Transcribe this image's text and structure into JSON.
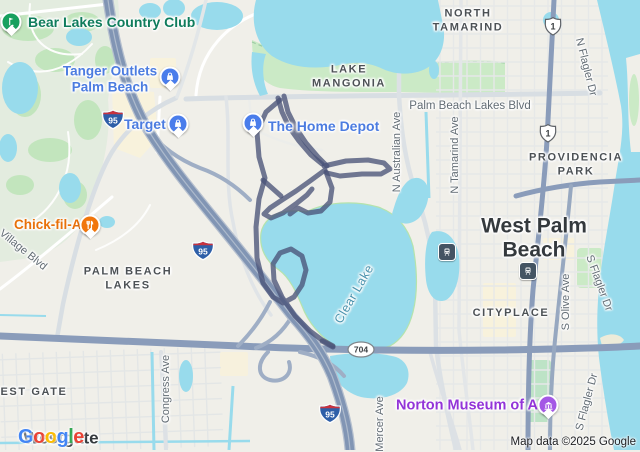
{
  "map": {
    "attribution": "Map data ©2025 Google",
    "google_logo": {
      "letters": [
        {
          "ch": "G",
          "color": "#4285F4"
        },
        {
          "ch": "o",
          "color": "#EA4335"
        },
        {
          "ch": "o",
          "color": "#FBBC05"
        },
        {
          "ch": "g",
          "color": "#4285F4"
        },
        {
          "ch": "l",
          "color": "#34A853"
        },
        {
          "ch": "e",
          "color": "#EA4335"
        }
      ]
    },
    "colors": {
      "land": "#F0EFE9",
      "water": "#98DBEC",
      "route": "#4A5378",
      "freeway": "#8195B4",
      "major_road": "#8A9CBA",
      "shopping_poi": "#4C7CE0",
      "restaurant_poi": "#E8710A",
      "attraction_poi": "#9334D8",
      "park_poi": "#0F7C5C"
    },
    "pois": [
      {
        "id": "bear-lakes-country-club",
        "lines": [
          "Bear Lakes Country Club"
        ],
        "color": "#0F7C5C",
        "size": 14,
        "icon": "golf-icon",
        "pin": {
          "x": 11,
          "y": 22,
          "bg": "#17A05E"
        },
        "text": {
          "x": 28,
          "y": 22,
          "align": "left"
        }
      },
      {
        "id": "tanger-outlets-palm-beach",
        "lines": [
          "Tanger Outlets",
          "Palm Beach"
        ],
        "color": "#4C7CE0",
        "size": 13.5,
        "icon": "shopping-bag-icon",
        "pin": {
          "x": 170,
          "y": 77,
          "bg": "#4A7DEB"
        },
        "text": {
          "x": 110,
          "y": 79,
          "align": "center"
        }
      },
      {
        "id": "target",
        "lines": [
          "Target"
        ],
        "color": "#4C7CE0",
        "size": 14,
        "icon": "shopping-bag-icon",
        "pin": {
          "x": 178,
          "y": 124,
          "bg": "#4A7DEB"
        },
        "text": {
          "x": 124,
          "y": 124,
          "align": "left"
        }
      },
      {
        "id": "the-home-depot",
        "lines": [
          "The Home Depot"
        ],
        "color": "#4C7CE0",
        "size": 14,
        "icon": "shopping-bag-icon",
        "pin": {
          "x": 253,
          "y": 123,
          "bg": "#4A7DEB"
        },
        "text": {
          "x": 268,
          "y": 126,
          "align": "left"
        }
      },
      {
        "id": "chick-fil-a",
        "lines": [
          "Chick-fil-A"
        ],
        "color": "#E8710A",
        "size": 13.5,
        "icon": "restaurant-icon",
        "pin": {
          "x": 90,
          "y": 225,
          "bg": "#F1760C"
        },
        "text": {
          "x": 14,
          "y": 225,
          "align": "left"
        }
      },
      {
        "id": "norton-museum-of-art",
        "lines": [
          "Norton Museum of Art"
        ],
        "color": "#9334D8",
        "size": 14.5,
        "icon": "museum-icon",
        "pin": {
          "x": 548,
          "y": 405,
          "bg": "#A458E5"
        },
        "text": {
          "x": 396,
          "y": 406,
          "align": "left"
        }
      }
    ],
    "area_labels": [
      {
        "id": "lake-mangonia",
        "lines": [
          "LAKE",
          "MANGONIA"
        ],
        "x": 349,
        "y": 77
      },
      {
        "id": "north-tamarind",
        "lines": [
          "NORTH",
          "TAMARIND"
        ],
        "x": 468,
        "y": 21
      },
      {
        "id": "providencia-park",
        "lines": [
          "PROVIDENCIA",
          "PARK"
        ],
        "x": 576,
        "y": 165
      },
      {
        "id": "palm-beach-lakes",
        "lines": [
          "PALM BEACH",
          "LAKES"
        ],
        "x": 128,
        "y": 279
      },
      {
        "id": "cityplace",
        "lines": [
          "CITYPLACE"
        ],
        "x": 511,
        "y": 313
      },
      {
        "id": "west-gate",
        "lines": [
          "WEST GATE"
        ],
        "x": 28,
        "y": 392
      }
    ],
    "city_labels": [
      {
        "id": "west-palm-beach",
        "lines": [
          "West Palm",
          "Beach"
        ],
        "x": 534,
        "y": 238,
        "size": 21
      },
      {
        "id": "westgate",
        "lines": [
          "Westgate"
        ],
        "x": 61,
        "y": 438,
        "size": 17
      }
    ],
    "water_labels": [
      {
        "id": "clear-lake",
        "label": "Clear Lake",
        "x": 354,
        "y": 294,
        "rot": -60,
        "color": "#4A93AE"
      }
    ],
    "street_labels": [
      {
        "id": "palm-beach-lakes-blvd",
        "label": "Palm Beach Lakes Blvd",
        "x": 470,
        "y": 106,
        "rot": 0,
        "size": 11.5
      },
      {
        "id": "n-australian-ave",
        "label": "N Australian Ave",
        "x": 397,
        "y": 152,
        "rot": -90,
        "size": 11
      },
      {
        "id": "n-tamarind-ave",
        "label": "N Tamarind Ave",
        "x": 455,
        "y": 155,
        "rot": -90,
        "size": 11
      },
      {
        "id": "n-flagler-dr",
        "label": "N Flagler Dr",
        "x": 586,
        "y": 67,
        "rot": 76,
        "size": 11
      },
      {
        "id": "village-blvd",
        "label": "Village Blvd",
        "x": 23,
        "y": 250,
        "rot": 39,
        "size": 11
      },
      {
        "id": "congress-ave",
        "label": "Congress Ave",
        "x": 166,
        "y": 389,
        "rot": -90,
        "size": 11
      },
      {
        "id": "mercer-ave",
        "label": "Mercer Ave",
        "x": 380,
        "y": 424,
        "rot": -90,
        "size": 11
      },
      {
        "id": "s-olive-ave",
        "label": "S Olive Ave",
        "x": 566,
        "y": 302,
        "rot": -90,
        "size": 11
      },
      {
        "id": "s-flagler-dr-north",
        "label": "S Flagler Dr",
        "x": 599,
        "y": 283,
        "rot": 70,
        "size": 11
      },
      {
        "id": "s-flagler-dr-south",
        "label": "S Flagler Dr",
        "x": 587,
        "y": 402,
        "rot": -75,
        "size": 11
      }
    ],
    "shields": [
      {
        "type": "interstate",
        "num": "95",
        "x": 113,
        "y": 122
      },
      {
        "type": "interstate",
        "num": "95",
        "x": 203,
        "y": 253
      },
      {
        "type": "interstate",
        "num": "95",
        "x": 330,
        "y": 416
      },
      {
        "type": "us",
        "num": "1",
        "x": 553,
        "y": 29
      },
      {
        "type": "us",
        "num": "1",
        "x": 548,
        "y": 136
      },
      {
        "type": "state-oval",
        "num": "704",
        "x": 361,
        "y": 352
      }
    ],
    "transit_stations": [
      {
        "id": "transit-station-1",
        "x": 447,
        "y": 252
      },
      {
        "id": "transit-station-2",
        "x": 528,
        "y": 271
      }
    ],
    "route": {
      "color": "#4A5378",
      "width": 5,
      "opacity": 0.78,
      "paths": [
        "278,98 282,112 289,127 299,141 311,155 322,164",
        "284,96 288,112 296,128 306,143 318,157 327,166",
        "324,166 346,161 368,160 384,163 390,169 381,174 362,174 340,176 327,173",
        "325,170 310,181 296,191 282,200 270,208 264,214 271,218 283,213 297,203 307,195 312,189",
        "326,172 332,188 330,202 321,211 308,213 298,208 290,214",
        "280,100 266,112 257,132 259,157 265,178 259,199 256,227 257,258 263,283 273,297 283,303 294,297 302,285 306,270 302,256 291,249 280,253 273,264 274,280 282,297 295,316 310,331 322,340 333,346",
        "263,180 272,188 281,196",
        "322,341 333,347"
      ]
    }
  }
}
